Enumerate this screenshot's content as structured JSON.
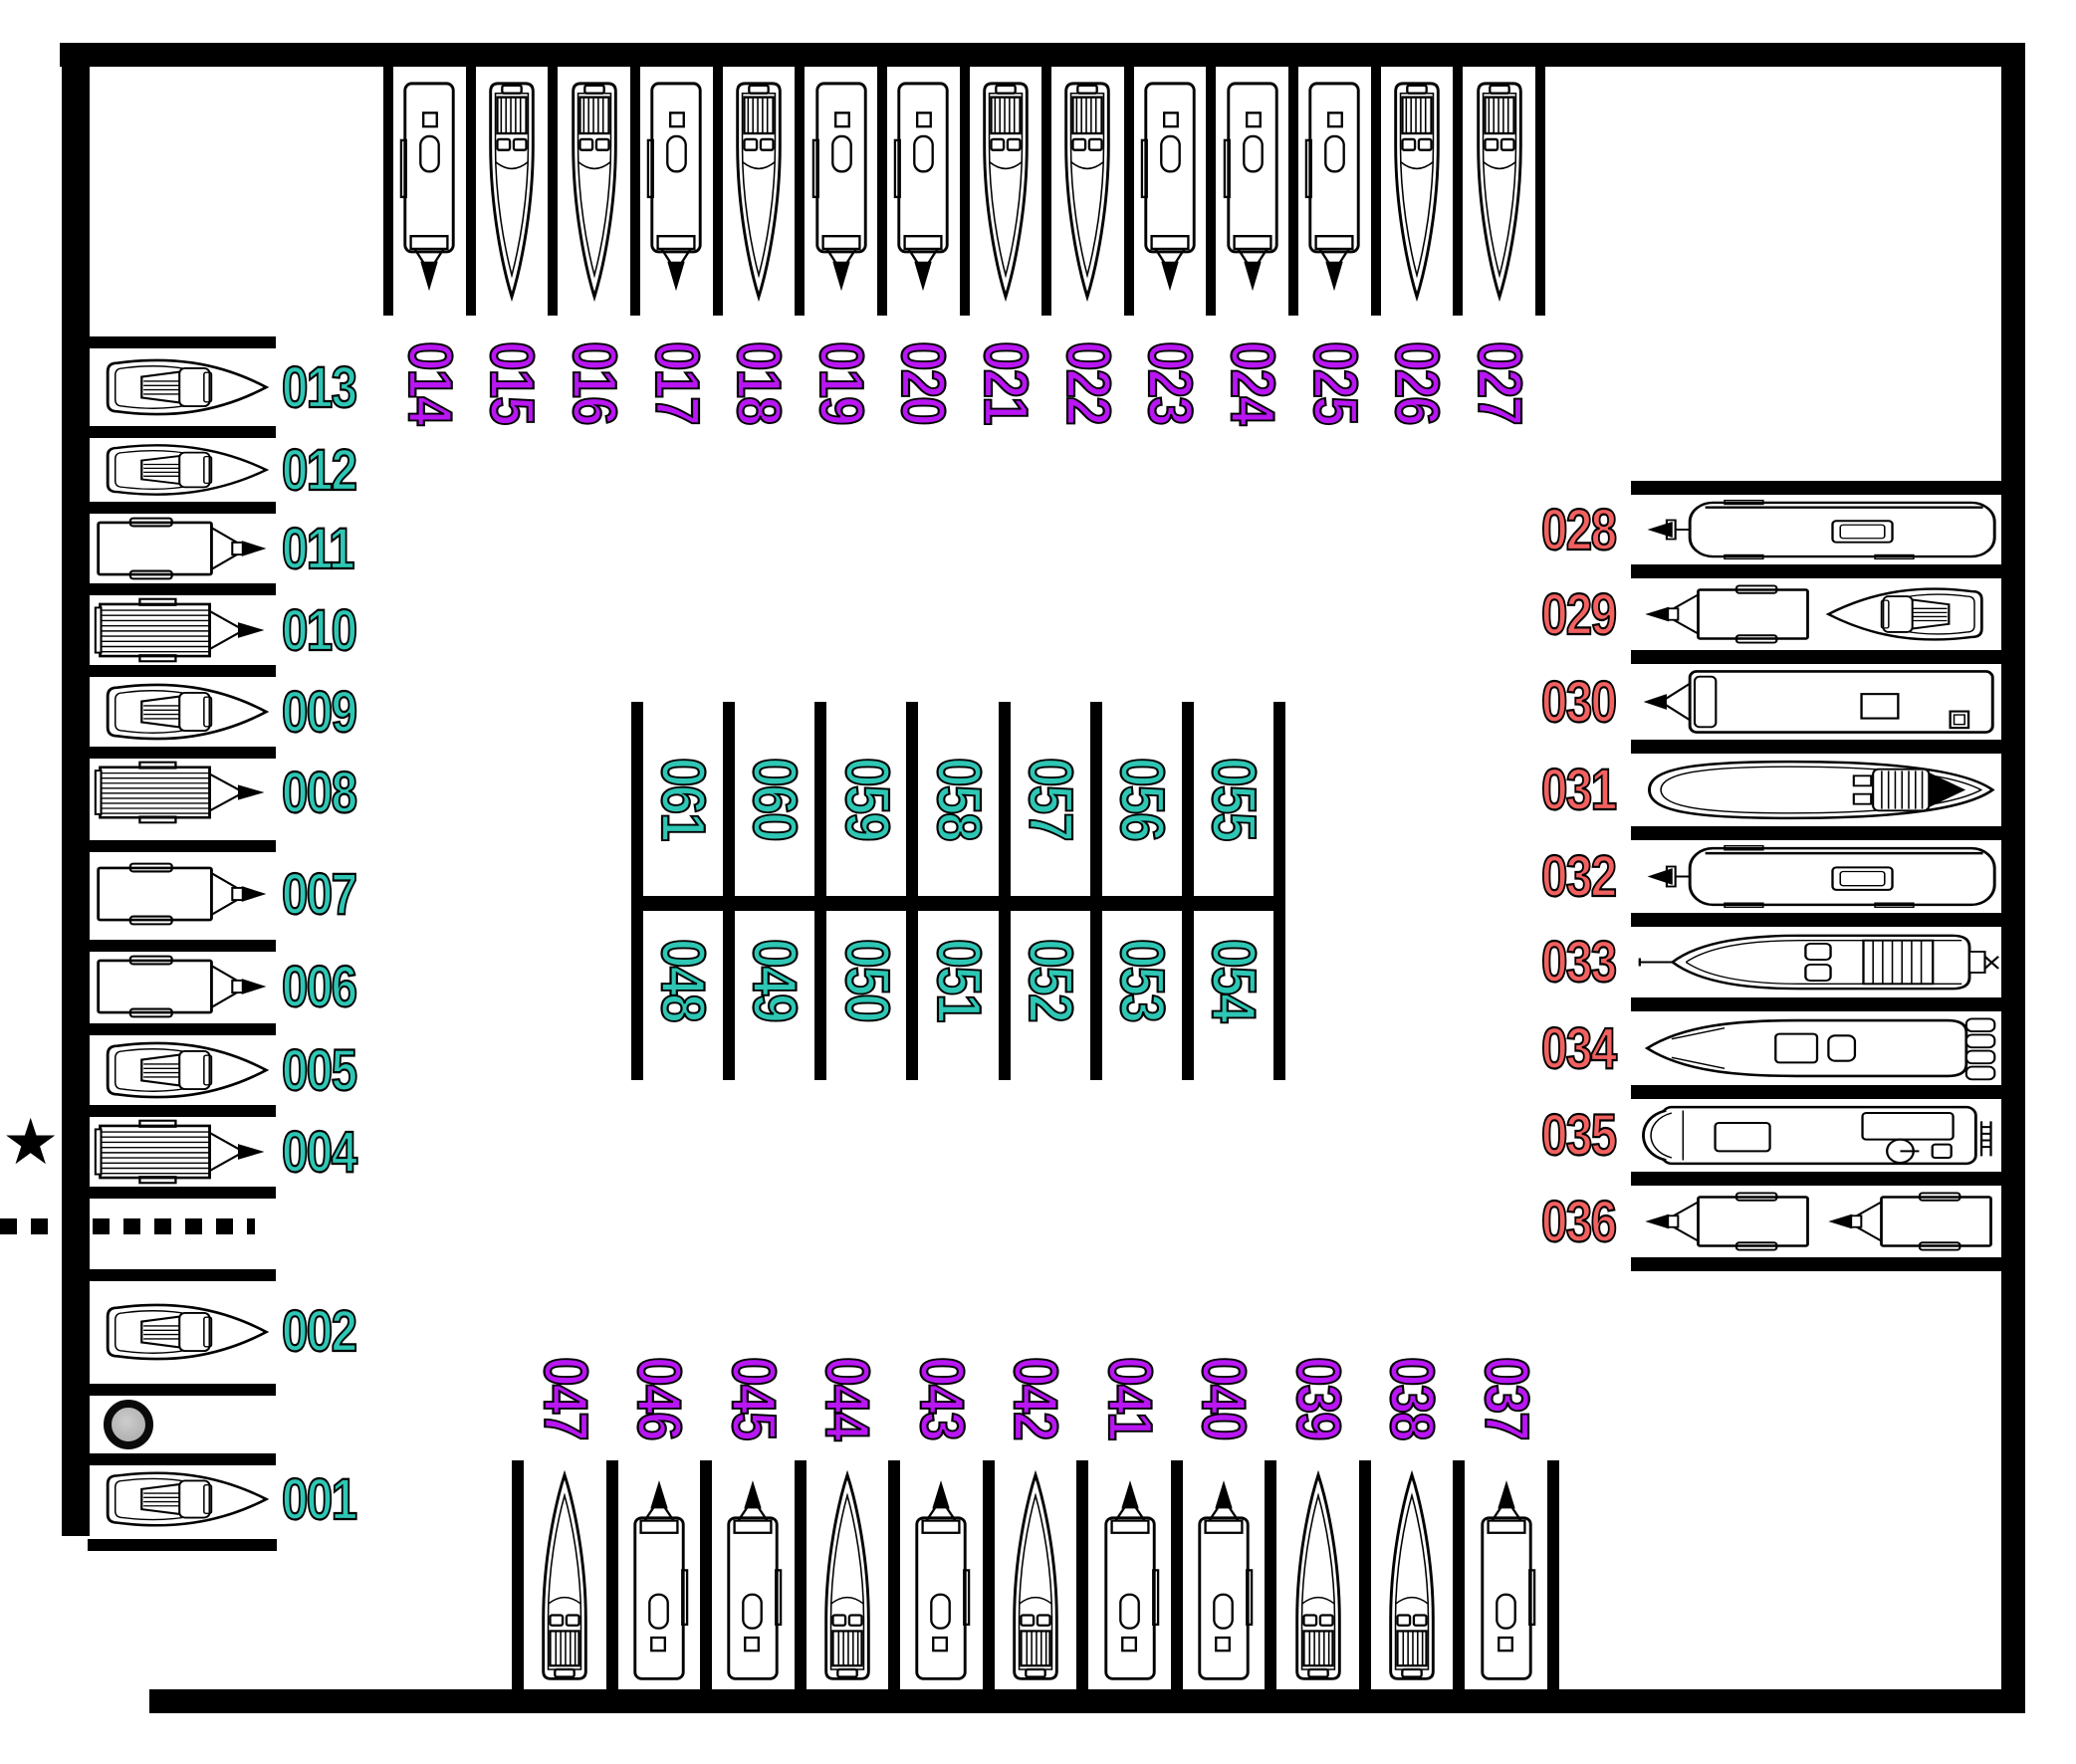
{
  "colors": {
    "top_row_labels": "#b816f2",
    "bottom_row_labels": "#b816f2",
    "left_column_labels": "#2ec6b4",
    "center_labels": "#2ec6b4",
    "right_column_labels": "#f26060",
    "walls": "#000000",
    "background": "#ffffff",
    "circle_marker_fill": "#b3b3b3"
  },
  "zones": {
    "top_row": {
      "slots": [
        {
          "id": "014",
          "vehicle": "cargo-trailer"
        },
        {
          "id": "015",
          "vehicle": "speedboat"
        },
        {
          "id": "016",
          "vehicle": "speedboat"
        },
        {
          "id": "017",
          "vehicle": "cargo-trailer"
        },
        {
          "id": "018",
          "vehicle": "speedboat"
        },
        {
          "id": "019",
          "vehicle": "cargo-trailer"
        },
        {
          "id": "020",
          "vehicle": "cargo-trailer"
        },
        {
          "id": "021",
          "vehicle": "speedboat"
        },
        {
          "id": "022",
          "vehicle": "speedboat"
        },
        {
          "id": "023",
          "vehicle": "cargo-trailer"
        },
        {
          "id": "024",
          "vehicle": "cargo-trailer"
        },
        {
          "id": "025",
          "vehicle": "cargo-trailer"
        },
        {
          "id": "026",
          "vehicle": "speedboat"
        },
        {
          "id": "027",
          "vehicle": "speedboat"
        }
      ]
    },
    "left_column": {
      "slots": [
        {
          "id": "013",
          "vehicle": "motorboat"
        },
        {
          "id": "012",
          "vehicle": "motorboat"
        },
        {
          "id": "011",
          "vehicle": "utility-trailer"
        },
        {
          "id": "010",
          "vehicle": "covered-boat"
        },
        {
          "id": "009",
          "vehicle": "motorboat"
        },
        {
          "id": "008",
          "vehicle": "covered-boat"
        },
        {
          "id": "007",
          "vehicle": "utility-trailer"
        },
        {
          "id": "006",
          "vehicle": "utility-trailer"
        },
        {
          "id": "005",
          "vehicle": "motorboat"
        },
        {
          "id": "004",
          "vehicle": "covered-boat",
          "marker": "star"
        },
        {
          "id": "",
          "vehicle": "",
          "marker": "dashed-line"
        },
        {
          "id": "002",
          "vehicle": "motorboat"
        },
        {
          "id": "",
          "vehicle": "",
          "marker": "circle"
        },
        {
          "id": "001",
          "vehicle": "motorboat"
        }
      ]
    },
    "right_column": {
      "slots": [
        {
          "id": "028",
          "vehicle": "camper-trailer"
        },
        {
          "id": "029",
          "vehicle": "utility-trailer-and-motorboat"
        },
        {
          "id": "030",
          "vehicle": "pontoon-boat"
        },
        {
          "id": "031",
          "vehicle": "yacht"
        },
        {
          "id": "032",
          "vehicle": "camper-trailer"
        },
        {
          "id": "033",
          "vehicle": "speedboat-on-trailer"
        },
        {
          "id": "034",
          "vehicle": "console-boat"
        },
        {
          "id": "035",
          "vehicle": "rv-camper"
        },
        {
          "id": "036",
          "vehicle": "two-utility-trailers"
        }
      ]
    },
    "bottom_row": {
      "slots": [
        {
          "id": "047",
          "vehicle": "speedboat"
        },
        {
          "id": "046",
          "vehicle": "cargo-trailer"
        },
        {
          "id": "045",
          "vehicle": "cargo-trailer"
        },
        {
          "id": "044",
          "vehicle": "speedboat"
        },
        {
          "id": "043",
          "vehicle": "cargo-trailer"
        },
        {
          "id": "042",
          "vehicle": "speedboat"
        },
        {
          "id": "041",
          "vehicle": "cargo-trailer"
        },
        {
          "id": "040",
          "vehicle": "cargo-trailer"
        },
        {
          "id": "039",
          "vehicle": "speedboat"
        },
        {
          "id": "038",
          "vehicle": "speedboat"
        },
        {
          "id": "037",
          "vehicle": "cargo-trailer"
        }
      ]
    },
    "center_top_row": {
      "slots": [
        {
          "id": "061",
          "vehicle": ""
        },
        {
          "id": "060",
          "vehicle": ""
        },
        {
          "id": "059",
          "vehicle": ""
        },
        {
          "id": "058",
          "vehicle": ""
        },
        {
          "id": "057",
          "vehicle": ""
        },
        {
          "id": "056",
          "vehicle": ""
        },
        {
          "id": "055",
          "vehicle": ""
        }
      ]
    },
    "center_bottom_row": {
      "slots": [
        {
          "id": "048",
          "vehicle": ""
        },
        {
          "id": "049",
          "vehicle": ""
        },
        {
          "id": "050",
          "vehicle": ""
        },
        {
          "id": "051",
          "vehicle": ""
        },
        {
          "id": "052",
          "vehicle": ""
        },
        {
          "id": "053",
          "vehicle": ""
        },
        {
          "id": "054",
          "vehicle": ""
        }
      ]
    }
  },
  "markers": {
    "star": {
      "glyph": "★",
      "at_slot": "004"
    },
    "dashed_line": {
      "between_slots": [
        "004",
        "002"
      ]
    },
    "circle": {
      "between_slots": [
        "002",
        "001"
      ]
    }
  }
}
